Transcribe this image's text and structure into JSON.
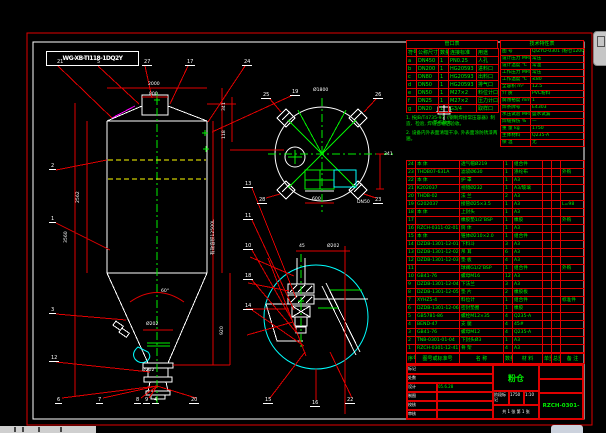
{
  "sheet": {
    "top_left_label": "WG-XB-TI118-1DQ2Y",
    "colors": {
      "background": "#000000",
      "geometry": "#ffffff",
      "dimension": "#ff0000",
      "centerline": "#00ff00",
      "phantom": "#ffff00",
      "detail": "#00ffff",
      "aux": "#ff00ff"
    }
  },
  "nozzle_table": {
    "title": "管口表",
    "headers": [
      "符号",
      "公称尺寸",
      "数量",
      "连接标准",
      "用途"
    ],
    "rows": [
      [
        "a",
        "DN450",
        "1",
        "PN0.25",
        "人孔"
      ],
      [
        "b",
        "DN200",
        "1",
        "HG20593",
        "进料口"
      ],
      [
        "c",
        "DN80",
        "1",
        "HG20593",
        "出料口"
      ],
      [
        "d",
        "DN50",
        "1",
        "HG20593",
        "排气口"
      ],
      [
        "e",
        "DN50",
        "1",
        "M27×2",
        "料位计口"
      ],
      [
        "f",
        "DN25",
        "1",
        "M27×2",
        "压力计口"
      ],
      [
        "g",
        "DN20",
        "1",
        "G3/4",
        "取样口"
      ]
    ]
  },
  "tech_table": {
    "title": "技术特性表",
    "rows": [
      [
        "图 号",
        "Q/ZYD-0301 (粉仓12000L)"
      ],
      [
        "设计压力 MPa",
        "常压"
      ],
      [
        "设计温度 ℃",
        "常温"
      ],
      [
        "工作压力 MPa",
        "常压"
      ],
      [
        "工作温度 ℃",
        "≤80"
      ],
      [
        "全容积 m³",
        "12.5"
      ],
      [
        "介 质",
        "PVC粉料"
      ],
      [
        "腐蚀裕度 mm",
        "1"
      ],
      [
        "焊条牌号",
        "E4303"
      ],
      [
        "水压试验 MPa",
        "盛水试漏"
      ],
      [
        "焊缝探伤 %",
        "—"
      ],
      [
        "重 量 kg",
        "1750"
      ],
      [
        "主体材料",
        "Q235-A"
      ],
      [
        "保 温",
        "无"
      ]
    ]
  },
  "notes": [
    "1. 按JB/T4735-97《钢制焊接常压容器》制造、检验, 焊缝合格后验收。",
    "2. 设备内外表面清理干净, 外表面涂防锈漆两遍。"
  ],
  "bom": {
    "headers": [
      "序号",
      "图号或标准号",
      "名 称",
      "数量",
      "材 料",
      "单重",
      "总重",
      "备 注"
    ],
    "rows": [
      [
        "24",
        "本 体",
        "透气帽Ø219",
        "1",
        "组合件",
        "",
        "",
        ""
      ],
      [
        "23",
        "THDB07-631A",
        "滤袋Ø630",
        "1",
        "涤纶布",
        "",
        "",
        "外购"
      ],
      [
        "22",
        "本 体",
        "护 罩",
        "1",
        "A3",
        "",
        "",
        ""
      ],
      [
        "21",
        "K202037",
        "视镜Ø232",
        "1",
        "A3/玻璃",
        "",
        "",
        ""
      ],
      [
        "20",
        "THDB-02",
        "法 兰",
        "2",
        "A3",
        "",
        "",
        ""
      ],
      [
        "19",
        "G202037",
        "接管Ø25×3.5",
        "1",
        "A3",
        "",
        "",
        "L=98"
      ],
      [
        "18",
        "本 体",
        "上封头",
        "1",
        "A3",
        "",
        "",
        ""
      ],
      [
        "17",
        "",
        "橡胶垫1/2″BSP",
        "1",
        "橡胶",
        "",
        "",
        "外购"
      ],
      [
        "16",
        "RZCH-0311-02-01",
        "筒 体",
        "1",
        "A3",
        "",
        "",
        ""
      ],
      [
        "15",
        "本 体",
        "锥体Ø210×2.0",
        "1",
        "组合件",
        "",
        "",
        ""
      ],
      [
        "14",
        "DZDB-1301-12-01",
        "下料斗",
        "3",
        "A3",
        "",
        "",
        ""
      ],
      [
        "13",
        "DZDB-1301-12-02",
        "吊 耳",
        "6",
        "A3",
        "",
        "",
        ""
      ],
      [
        "12",
        "DZDB-1301-12-03",
        "垫 板",
        "4",
        "A3",
        "",
        "",
        ""
      ],
      [
        "11",
        "",
        "球阀G1/2″BSP",
        "1",
        "组合件",
        "",
        "",
        "外购"
      ],
      [
        "10",
        "GB41-76",
        "螺母M16",
        "12",
        "A3",
        "",
        "",
        ""
      ],
      [
        "9",
        "DZDB-1301-12-04",
        "下法兰",
        "3",
        "A3",
        "",
        "",
        ""
      ],
      [
        "8",
        "DZDB-1301-12-05",
        "垫 片",
        "2",
        "橡胶板",
        "",
        "",
        ""
      ],
      [
        "7",
        "XYHZ5-4",
        "料位计",
        "1",
        "组合件",
        "",
        "",
        "标准件"
      ],
      [
        "6",
        "DZDB-1301-12-06",
        "密封垫圈",
        "1",
        "橡胶",
        "",
        "",
        ""
      ],
      [
        "5",
        "GB5781-86",
        "螺栓M12×35",
        "4",
        "Q235-A",
        "",
        "",
        ""
      ],
      [
        "4",
        "BEND-47",
        "支 腿",
        "4",
        "45#",
        "",
        "",
        ""
      ],
      [
        "3",
        "GB41-76",
        "螺母M12",
        "4",
        "Q235-A",
        "",
        "",
        ""
      ],
      [
        "2",
        "TNB-0301-01-04",
        "下封头Ø3",
        "1",
        "A3",
        "",
        "",
        ""
      ],
      [
        "1",
        "RZCH-0301-12-41",
        "骨 架",
        "4",
        "A3",
        "",
        "",
        ""
      ]
    ]
  },
  "title_block": {
    "title": "粉仓12000L",
    "drawing_no": "RZCH-0301-02-11",
    "sign_labels": [
      "标记",
      "处数",
      "设计",
      "制图",
      "校核",
      "审核"
    ],
    "date_value": "05.6.28",
    "stage_labels": [
      "阶段标记",
      "质量",
      "比例"
    ],
    "stage_values": [
      "",
      "1750",
      "1:10"
    ],
    "sheet_note": "共 1 张  第 1 张"
  },
  "annotations": {
    "balloons": [
      {
        "x": 55,
        "y": 60,
        "t": "21"
      },
      {
        "x": 95,
        "y": 60,
        "t": "5"
      },
      {
        "x": 142,
        "y": 60,
        "t": "27"
      },
      {
        "x": 185,
        "y": 60,
        "t": "17"
      },
      {
        "x": 242,
        "y": 60,
        "t": "24"
      },
      {
        "x": 290,
        "y": 90,
        "t": "19"
      },
      {
        "x": 49,
        "y": 164,
        "t": "2"
      },
      {
        "x": 49,
        "y": 217,
        "t": "1"
      },
      {
        "x": 49,
        "y": 308,
        "t": "3"
      },
      {
        "x": 49,
        "y": 356,
        "t": "12"
      },
      {
        "x": 243,
        "y": 182,
        "t": "13"
      },
      {
        "x": 243,
        "y": 214,
        "t": "11"
      },
      {
        "x": 243,
        "y": 244,
        "t": "10"
      },
      {
        "x": 243,
        "y": 274,
        "t": "18"
      },
      {
        "x": 243,
        "y": 304,
        "t": "14"
      },
      {
        "x": 55,
        "y": 398,
        "t": "6"
      },
      {
        "x": 96,
        "y": 398,
        "t": "7"
      },
      {
        "x": 134,
        "y": 398,
        "t": "8"
      },
      {
        "x": 143,
        "y": 398,
        "t": "9"
      },
      {
        "x": 152,
        "y": 398,
        "t": "4"
      },
      {
        "x": 189,
        "y": 398,
        "t": "20"
      },
      {
        "x": 263,
        "y": 398,
        "t": "15"
      },
      {
        "x": 310,
        "y": 401,
        "t": "16"
      },
      {
        "x": 345,
        "y": 398,
        "t": "22"
      },
      {
        "x": 261,
        "y": 93,
        "t": "25"
      },
      {
        "x": 373,
        "y": 93,
        "t": "26"
      },
      {
        "x": 257,
        "y": 198,
        "t": "28"
      },
      {
        "x": 373,
        "y": 198,
        "t": "23"
      }
    ],
    "dims": [
      {
        "x": 148,
        "y": 82,
        "t": "2000"
      },
      {
        "x": 149,
        "y": 92,
        "t": "800"
      },
      {
        "x": 69,
        "y": 238,
        "t": "3560",
        "rot": 1
      },
      {
        "x": 81,
        "y": 198,
        "t": "2562",
        "rot": 1
      },
      {
        "x": 227,
        "y": 106,
        "t": "341",
        "rot": 1
      },
      {
        "x": 227,
        "y": 134,
        "t": "118",
        "rot": 1
      },
      {
        "x": 216,
        "y": 250,
        "t": "有效容积12500L",
        "rot": 1
      },
      {
        "x": 225,
        "y": 330,
        "t": "920",
        "rot": 1
      },
      {
        "x": 146,
        "y": 322,
        "t": "Ø202"
      },
      {
        "x": 142,
        "y": 368,
        "t": "Ø202"
      },
      {
        "x": 161,
        "y": 289,
        "t": "60°"
      },
      {
        "x": 313,
        "y": 88,
        "t": "Ø1800"
      },
      {
        "x": 384,
        "y": 152,
        "t": "341"
      },
      {
        "x": 312,
        "y": 197,
        "t": "600"
      },
      {
        "x": 357,
        "y": 200,
        "t": "DN50"
      },
      {
        "x": 299,
        "y": 244,
        "t": "45"
      },
      {
        "x": 327,
        "y": 244,
        "t": "Ø202"
      },
      {
        "x": 433,
        "y": 121,
        "t": "节点放大",
        "grn": 1
      }
    ]
  }
}
